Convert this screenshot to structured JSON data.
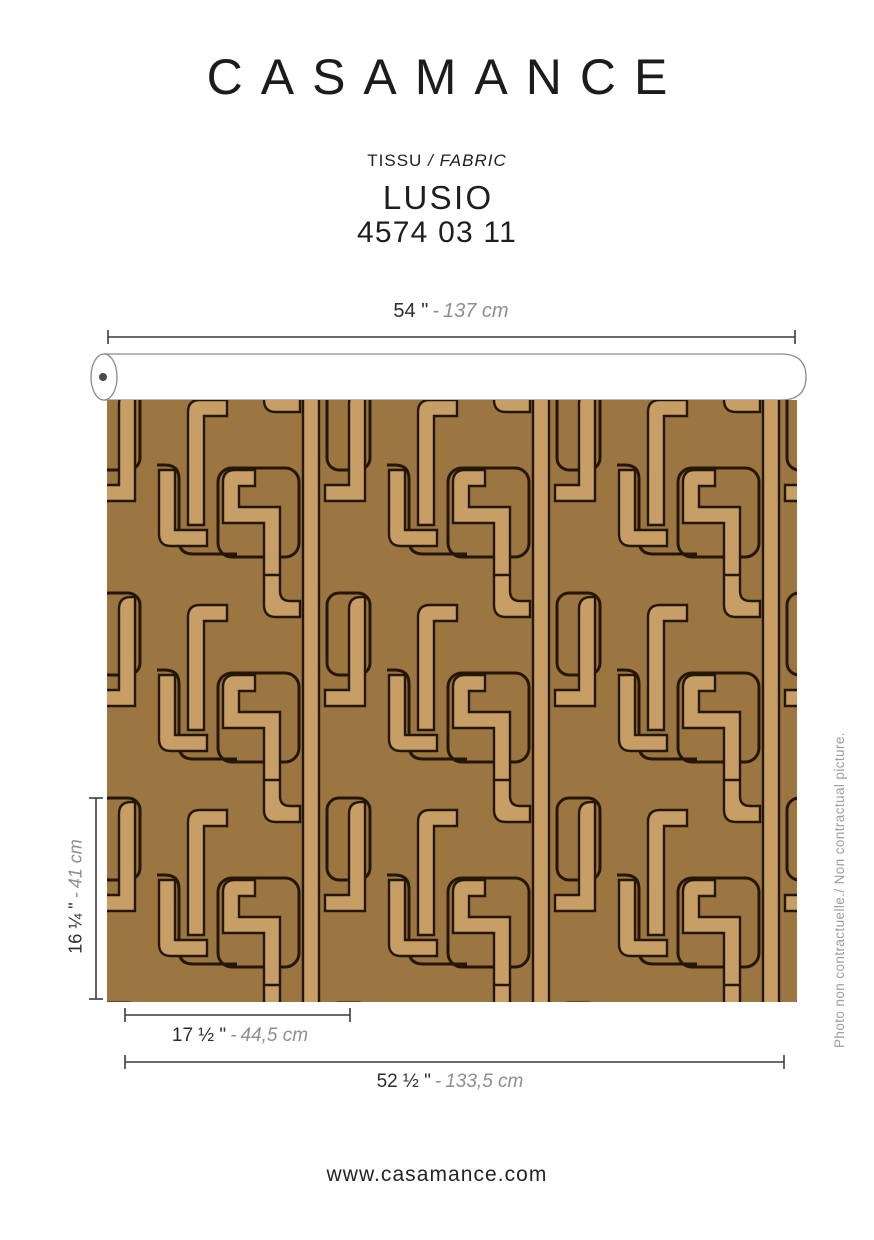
{
  "brand": "CASAMANCE",
  "product": {
    "category_fr": "TISSU",
    "slash": "/",
    "category_en": "FABRIC",
    "name": "LUSIO",
    "reference": "4574 03 11"
  },
  "dimensions": {
    "separator": "-",
    "roll_width": {
      "imperial": "54 \"",
      "metric": "137 cm"
    },
    "pattern_height": {
      "imperial": "16 ¼ \"",
      "metric": "41 cm"
    },
    "pattern_width": {
      "imperial": "17 ½ \"",
      "metric": "44,5 cm"
    },
    "usable_width": {
      "imperial": "52 ½ \"",
      "metric": "133,5 cm"
    }
  },
  "disclaimer": "Photo non contractuelle./ Non contractual picture.",
  "footer": {
    "website": "www.casamance.com"
  },
  "colors": {
    "fabric_ground": "#9b7640",
    "fabric_ribbon": "#c79e66",
    "fabric_outline": "#241707",
    "heading_text": "#1c1c1c",
    "metric_text": "#8f8f8f"
  }
}
